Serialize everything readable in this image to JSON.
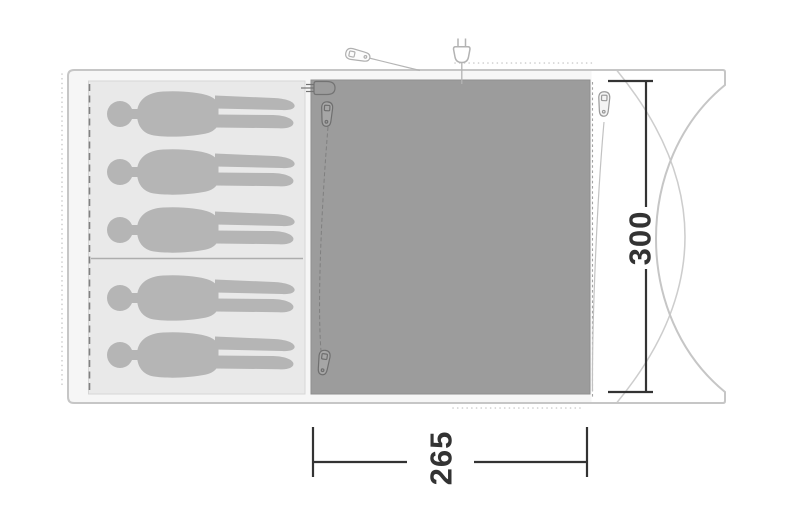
{
  "diagram": {
    "type": "tent-floorplan-top-view",
    "dimensions": {
      "depth_label": "300",
      "width_label": "265"
    },
    "sleeping_cabin": {
      "person_count": 5,
      "top_section_persons": 3,
      "bottom_section_persons": 2
    },
    "icons": [
      "zipper-pull-icon",
      "power-plug-icon",
      "cable-entry-plug-icon"
    ],
    "colors": {
      "tent_outline": "#c6c6c6",
      "canvas_band": "#f6f6f6",
      "sleeping_area_fill": "#e9e9e9",
      "living_area_fill": "#9c9c9c",
      "person_fill": "#b5b5b5",
      "dimension_ink": "#333333"
    }
  }
}
